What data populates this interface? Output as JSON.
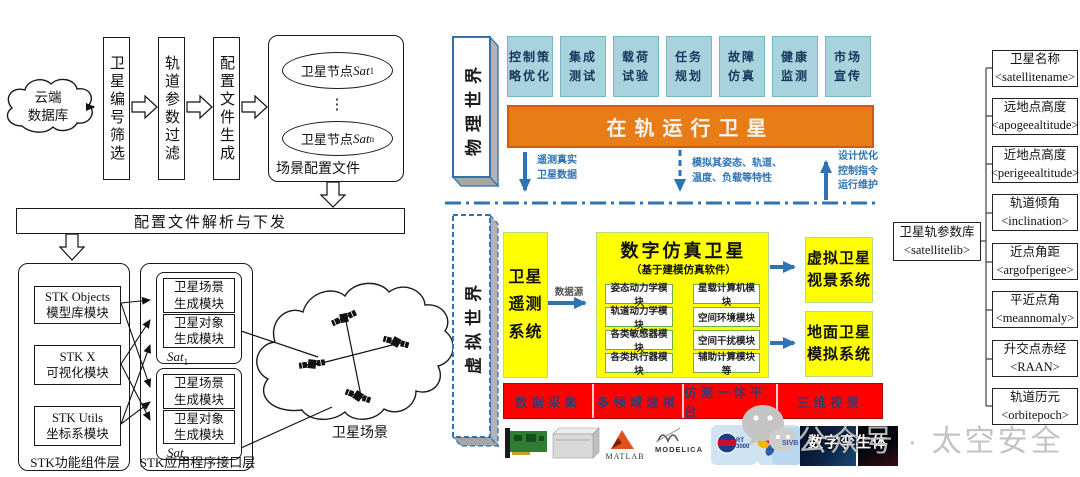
{
  "left": {
    "cloud_db": "云端\n数据库",
    "steps": [
      "卫星编号筛选",
      "轨道参数过滤",
      "配置文件生成"
    ],
    "scene": {
      "node_prefix": "卫星节点",
      "sat": "Sat",
      "sub_first": "1",
      "sub_last": "n",
      "dots": "⋮",
      "label": "场景配置文件"
    },
    "parse_bar": "配置文件解析与下发",
    "stk": {
      "boxes": [
        "STK Objects\n模型库模块",
        "STK X\n可视化模块",
        "STK Utils\n坐标系模块"
      ],
      "label": "STK功能组件层"
    },
    "api": {
      "groups": [
        {
          "scene_module": "卫星场景\n生成模块",
          "object_module": "卫星对象\n生成模块",
          "sat": "Sat",
          "sub": "1"
        },
        {
          "scene_module": "卫星场景\n生成模块",
          "object_module": "卫星对象\n生成模块",
          "sat": "Sat",
          "sub": "n"
        }
      ],
      "label": "STK应用程序接口层"
    },
    "scene_cloud_label": "卫星场景"
  },
  "physical": {
    "world_label": "物理世界",
    "apps": [
      "控制策\n略优化",
      "集成\n测试",
      "载荷\n试验",
      "任务\n规划",
      "故障\n仿真",
      "健康\n监测",
      "市场\n宣传"
    ],
    "orbit_bar": "在轨运行卫星",
    "telemetry_arrow_label": "遥测真实\n卫星数据",
    "simulate_arrow_label": "模拟其姿态、轨道、\n温度、负载等特性",
    "design_arrow_label": "设计优化\n控制指令\n运行维护"
  },
  "virtual": {
    "world_label": "虚拟世界",
    "telemetry_system": "卫星遥测系统",
    "datasource_label": "数据源",
    "digital_satellite": {
      "title": "数字仿真卫星",
      "subtitle": "（基于建模仿真软件）",
      "modules_left": [
        "姿态动力学模块",
        "轨道动力学模块",
        "各类敏感器模块",
        "各类执行器模块"
      ],
      "modules_right": [
        "星载计算机模块",
        "空间环境模块",
        "空间干扰模块",
        "辅助计算模块等"
      ]
    },
    "view_system": "虚拟卫星\n视景系统",
    "ground_system": "地面卫星\n模拟系统",
    "capabilities": [
      "数据采集",
      "多领域建模",
      "仿测一体平台",
      "三维视景"
    ],
    "logos": {
      "matlab": "MATLAB",
      "modelica": "MODELICA",
      "rt_tile": "RT 3000",
      "sivb_tile": "SIVB",
      "twin_label": "数字孪生体"
    }
  },
  "params": {
    "library": "卫星轨参数库\n<satellitelib>",
    "items": [
      "卫星名称\n<satellitename>",
      "远地点高度\n<apogeealtitude>",
      "近地点高度\n<perigeealtitude>",
      "轨道倾角\n<inclination>",
      "近点角距\n<argofperigee>",
      "平近点角\n<meannomaly>",
      "升交点赤经\n<RAAN>",
      "轨道历元\n<orbitepoch>"
    ]
  },
  "watermark": "公众号 · 太空安全"
}
